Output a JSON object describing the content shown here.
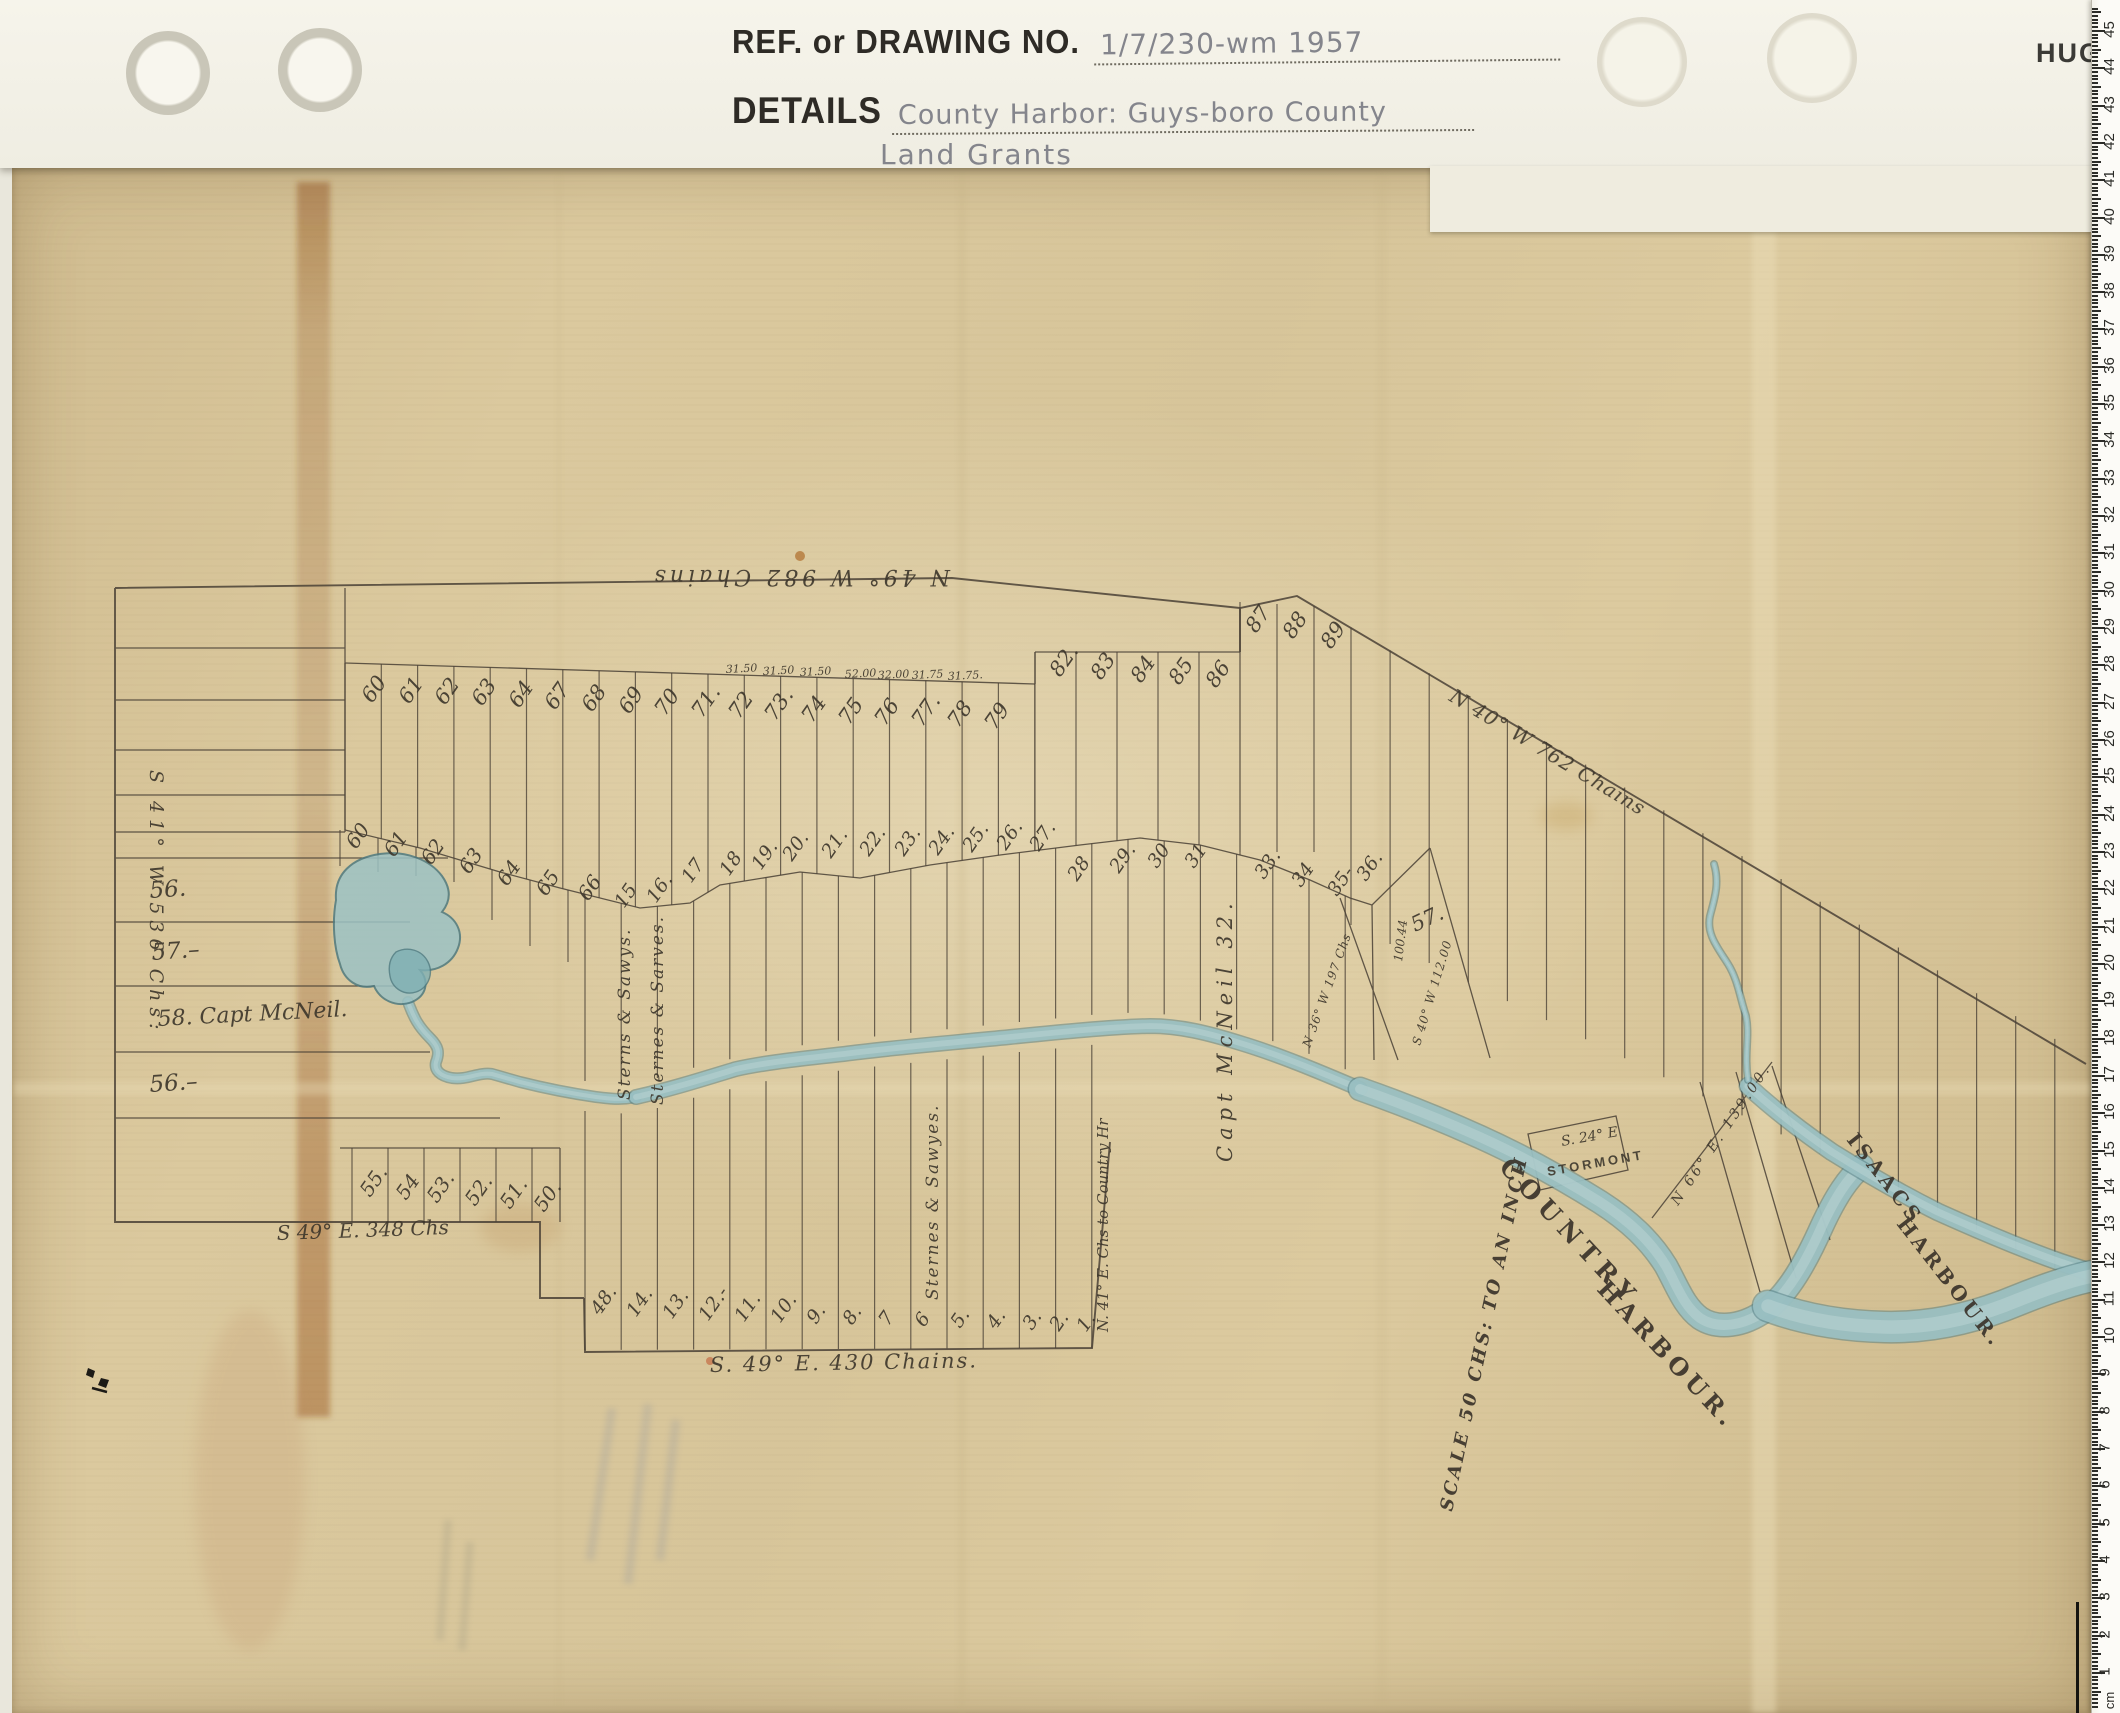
{
  "header": {
    "ref_label": "REF. or DRAWING NO.",
    "ref_value": "1/7/230-wm 1957",
    "details_label": "DETAILS",
    "details_line1": "County Harbor: Guys-boro County",
    "details_line2": "Land Grants",
    "brand_partial": "HUGH"
  },
  "ruler": {
    "unit_label": "cm",
    "min": 1,
    "max": 45
  },
  "colors": {
    "paper": "#d8c69b",
    "ink": "#4a4136",
    "water_light": "#9cc2c4",
    "water_dark": "#4e7a80",
    "stain_brown": "#92541f",
    "pencil": "#84858c"
  },
  "map": {
    "labels": [
      {
        "t": "N 49° W 982 Chains",
        "x": 950,
        "y": 570,
        "r": 180,
        "s": 22,
        "ls": 4,
        "c": "scr"
      },
      {
        "t": "S 41° W 536 Chs:",
        "x": 150,
        "y": 770,
        "r": 90,
        "s": 19,
        "ls": 6,
        "c": "scr"
      },
      {
        "t": "56.",
        "x": 150,
        "y": 898,
        "r": -4,
        "s": 23,
        "c": "scr"
      },
      {
        "t": "57.–",
        "x": 152,
        "y": 960,
        "r": -4,
        "s": 23,
        "c": "scr"
      },
      {
        "t": "58. Capt McNeil.",
        "x": 158,
        "y": 1026,
        "r": -3,
        "s": 22,
        "c": "scr"
      },
      {
        "t": "56.–",
        "x": 150,
        "y": 1092,
        "r": -4,
        "s": 23,
        "c": "scr"
      },
      {
        "t": "S 49° E. 348 Chs",
        "x": 277,
        "y": 1240,
        "r": -2,
        "s": 20,
        "c": "scr"
      },
      {
        "t": "S. 49° E.  430 Chains.",
        "x": 710,
        "y": 1372,
        "r": -1,
        "s": 21,
        "ls": 2,
        "c": "scr"
      },
      {
        "t": "N 40° W 762 Chains",
        "x": 1448,
        "y": 700,
        "r": 31,
        "s": 20,
        "ls": 1,
        "c": "scr"
      },
      {
        "t": "Capt McNeil 32.",
        "x": 1232,
        "y": 1162,
        "r": -90,
        "s": 21,
        "ls": 6,
        "c": "scr"
      },
      {
        "t": "Sterns & Sawys.",
        "x": 630,
        "y": 1100,
        "r": -90,
        "s": 17,
        "ls": 2,
        "c": "scr"
      },
      {
        "t": "Sternes & Sarves.",
        "x": 663,
        "y": 1105,
        "r": -90,
        "s": 17,
        "ls": 2,
        "c": "scr"
      },
      {
        "t": "Sternes & Sawyes.",
        "x": 938,
        "y": 1300,
        "r": -90,
        "s": 17,
        "ls": 2,
        "c": "scr"
      },
      {
        "t": "N. 41° E. Chs to Country Hr",
        "x": 1108,
        "y": 1332,
        "r": -90,
        "s": 15,
        "c": "scr"
      },
      {
        "t": "100.44",
        "x": 1402,
        "y": 962,
        "r": -83,
        "s": 12,
        "c": "scr"
      },
      {
        "t": "57.",
        "x": 1415,
        "y": 932,
        "r": -25,
        "s": 21,
        "c": "scr"
      },
      {
        "t": "S 40° W 112.00",
        "x": 1420,
        "y": 1046,
        "r": -73,
        "s": 12,
        "ls": 1,
        "c": "scr"
      },
      {
        "t": "N 36° W 197 Chs",
        "x": 1310,
        "y": 1048,
        "r": -70,
        "s": 12,
        "ls": 1,
        "c": "scr"
      },
      {
        "t": "S. 24° E",
        "x": 1562,
        "y": 1146,
        "r": -10,
        "s": 14,
        "c": "scr"
      },
      {
        "t": "STORMONT",
        "x": 1548,
        "y": 1176,
        "r": -10,
        "s": 13,
        "ls": 3,
        "c": "prt"
      },
      {
        "t": "N 66° E. 139.00.",
        "x": 1678,
        "y": 1206,
        "r": -56,
        "s": 14,
        "ls": 3,
        "c": "scr"
      },
      {
        "t": "COUNTRY",
        "x": 1498,
        "y": 1168,
        "r": 47,
        "s": 25,
        "ls": 7,
        "c": "prt2"
      },
      {
        "t": "HARBOUR.",
        "x": 1596,
        "y": 1290,
        "r": 47,
        "s": 24,
        "ls": 5,
        "c": "prt2"
      },
      {
        "t": "ISAACS",
        "x": 1846,
        "y": 1140,
        "r": 52,
        "s": 20,
        "ls": 4,
        "c": "prt2"
      },
      {
        "t": "HARBOUR.",
        "x": 1896,
        "y": 1224,
        "r": 52,
        "s": 20,
        "ls": 4,
        "c": "prt2"
      },
      {
        "t": "SCALE 50 CHS: TO AN INCH",
        "x": 1452,
        "y": 1512,
        "r": -78,
        "s": 18,
        "ls": 3,
        "c": "scr2"
      },
      {
        "t": "60",
        "x": 372,
        "y": 704,
        "r": -55,
        "s": 21,
        "c": "scr"
      },
      {
        "t": "61",
        "x": 409,
        "y": 705,
        "r": -55,
        "s": 21,
        "c": "scr"
      },
      {
        "t": "62",
        "x": 445,
        "y": 706,
        "r": -55,
        "s": 21,
        "c": "scr"
      },
      {
        "t": "63",
        "x": 482,
        "y": 707,
        "r": -55,
        "s": 21,
        "c": "scr"
      },
      {
        "t": "64",
        "x": 519,
        "y": 709,
        "r": -55,
        "s": 21,
        "c": "scr"
      },
      {
        "t": "67",
        "x": 555,
        "y": 711,
        "r": -55,
        "s": 21,
        "c": "scr"
      },
      {
        "t": "68",
        "x": 592,
        "y": 713,
        "r": -55,
        "s": 21,
        "c": "scr"
      },
      {
        "t": "69",
        "x": 629,
        "y": 715,
        "r": -55,
        "s": 21,
        "c": "scr"
      },
      {
        "t": "70",
        "x": 665,
        "y": 717,
        "r": -55,
        "s": 21,
        "c": "scr"
      },
      {
        "t": "71.",
        "x": 702,
        "y": 719,
        "r": -55,
        "s": 21,
        "c": "scr"
      },
      {
        "t": "72",
        "x": 739,
        "y": 720,
        "r": -55,
        "s": 21,
        "c": "scr"
      },
      {
        "t": "73.",
        "x": 775,
        "y": 722,
        "r": -55,
        "s": 21,
        "c": "scr"
      },
      {
        "t": "74",
        "x": 812,
        "y": 724,
        "r": -55,
        "s": 21,
        "c": "scr"
      },
      {
        "t": "75",
        "x": 849,
        "y": 726,
        "r": -55,
        "s": 21,
        "c": "scr"
      },
      {
        "t": "76",
        "x": 885,
        "y": 727,
        "r": -55,
        "s": 21,
        "c": "scr"
      },
      {
        "t": "77.",
        "x": 922,
        "y": 728,
        "r": -55,
        "s": 21,
        "c": "scr"
      },
      {
        "t": "78",
        "x": 958,
        "y": 729,
        "r": -55,
        "s": 21,
        "c": "scr"
      },
      {
        "t": "79",
        "x": 995,
        "y": 731,
        "r": -55,
        "s": 21,
        "c": "scr"
      },
      {
        "t": "31.50",
        "x": 726,
        "y": 673,
        "r": -3,
        "s": 11,
        "c": "scr"
      },
      {
        "t": "31.50",
        "x": 763,
        "y": 675,
        "r": -3,
        "s": 11,
        "c": "scr"
      },
      {
        "t": "31.50",
        "x": 800,
        "y": 676,
        "r": -3,
        "s": 11,
        "c": "scr"
      },
      {
        "t": "52.00",
        "x": 845,
        "y": 678,
        "r": -3,
        "s": 11,
        "c": "scr"
      },
      {
        "t": "32.00",
        "x": 878,
        "y": 679,
        "r": -3,
        "s": 11,
        "c": "scr"
      },
      {
        "t": "31.75",
        "x": 912,
        "y": 679,
        "r": -3,
        "s": 11,
        "c": "scr"
      },
      {
        "t": "31.75.",
        "x": 948,
        "y": 680,
        "r": -3,
        "s": 11,
        "c": "scr"
      },
      {
        "t": "82.",
        "x": 1060,
        "y": 678,
        "r": -55,
        "s": 21,
        "c": "scr"
      },
      {
        "t": "83",
        "x": 1101,
        "y": 681,
        "r": -55,
        "s": 21,
        "c": "scr"
      },
      {
        "t": "84",
        "x": 1141,
        "y": 684,
        "r": -55,
        "s": 21,
        "c": "scr"
      },
      {
        "t": "85",
        "x": 1179,
        "y": 686,
        "r": -55,
        "s": 21,
        "c": "scr"
      },
      {
        "t": "86",
        "x": 1216,
        "y": 689,
        "r": -55,
        "s": 21,
        "c": "scr"
      },
      {
        "t": "87",
        "x": 1256,
        "y": 634,
        "r": -55,
        "s": 21,
        "c": "scr"
      },
      {
        "t": "88",
        "x": 1293,
        "y": 640,
        "r": -55,
        "s": 21,
        "c": "scr"
      },
      {
        "t": "89",
        "x": 1331,
        "y": 650,
        "r": -55,
        "s": 21,
        "c": "scr"
      },
      {
        "t": "60",
        "x": 356,
        "y": 850,
        "r": -55,
        "s": 20,
        "c": "scr"
      },
      {
        "t": "61",
        "x": 394,
        "y": 858,
        "r": -55,
        "s": 20,
        "c": "scr"
      },
      {
        "t": "62",
        "x": 431,
        "y": 866,
        "r": -55,
        "s": 20,
        "c": "scr"
      },
      {
        "t": "63",
        "x": 469,
        "y": 875,
        "r": -55,
        "s": 20,
        "c": "scr"
      },
      {
        "t": "64",
        "x": 507,
        "y": 887,
        "r": -55,
        "s": 20,
        "c": "scr"
      },
      {
        "t": "65",
        "x": 546,
        "y": 897,
        "r": -55,
        "s": 20,
        "c": "scr"
      },
      {
        "t": "66",
        "x": 588,
        "y": 902,
        "r": -55,
        "s": 20,
        "c": "scr"
      },
      {
        "t": "15",
        "x": 624,
        "y": 909,
        "r": -55,
        "s": 19,
        "c": "scr"
      },
      {
        "t": "16.",
        "x": 656,
        "y": 904,
        "r": -55,
        "s": 19,
        "c": "scr"
      },
      {
        "t": "17",
        "x": 691,
        "y": 884,
        "r": -55,
        "s": 19,
        "c": "scr"
      },
      {
        "t": "18",
        "x": 729,
        "y": 877,
        "r": -55,
        "s": 19,
        "c": "scr"
      },
      {
        "t": "19.",
        "x": 761,
        "y": 871,
        "r": -55,
        "s": 19,
        "c": "scr"
      },
      {
        "t": "20.",
        "x": 792,
        "y": 862,
        "r": -55,
        "s": 19,
        "c": "scr"
      },
      {
        "t": "21.",
        "x": 831,
        "y": 859,
        "r": -55,
        "s": 19,
        "c": "scr"
      },
      {
        "t": "22.",
        "x": 869,
        "y": 857,
        "r": -55,
        "s": 19,
        "c": "scr"
      },
      {
        "t": "23.",
        "x": 904,
        "y": 857,
        "r": -55,
        "s": 19,
        "c": "scr"
      },
      {
        "t": "24.",
        "x": 938,
        "y": 856,
        "r": -55,
        "s": 19,
        "c": "scr"
      },
      {
        "t": "25.",
        "x": 972,
        "y": 853,
        "r": -55,
        "s": 19,
        "c": "scr"
      },
      {
        "t": "26.",
        "x": 1006,
        "y": 851,
        "r": -55,
        "s": 19,
        "c": "scr"
      },
      {
        "t": "27.",
        "x": 1039,
        "y": 852,
        "r": -55,
        "s": 19,
        "c": "scr"
      },
      {
        "t": "28",
        "x": 1077,
        "y": 882,
        "r": -55,
        "s": 19,
        "c": "scr"
      },
      {
        "t": "29.",
        "x": 1119,
        "y": 874,
        "r": -55,
        "s": 19,
        "c": "scr"
      },
      {
        "t": "30",
        "x": 1157,
        "y": 869,
        "r": -55,
        "s": 19,
        "c": "scr"
      },
      {
        "t": "31",
        "x": 1194,
        "y": 869,
        "r": -55,
        "s": 19,
        "c": "scr"
      },
      {
        "t": "33.",
        "x": 1264,
        "y": 880,
        "r": -55,
        "s": 19,
        "c": "scr"
      },
      {
        "t": "34",
        "x": 1301,
        "y": 888,
        "r": -55,
        "s": 19,
        "c": "scr"
      },
      {
        "t": "35-",
        "x": 1337,
        "y": 897,
        "r": -55,
        "s": 19,
        "c": "scr"
      },
      {
        "t": "36.",
        "x": 1366,
        "y": 882,
        "r": -55,
        "s": 19,
        "c": "scr"
      },
      {
        "t": "55.",
        "x": 370,
        "y": 1198,
        "r": -55,
        "s": 20,
        "c": "scr"
      },
      {
        "t": "54",
        "x": 406,
        "y": 1201,
        "r": -55,
        "s": 20,
        "c": "scr"
      },
      {
        "t": "53.",
        "x": 437,
        "y": 1204,
        "r": -55,
        "s": 20,
        "c": "scr"
      },
      {
        "t": "52.",
        "x": 475,
        "y": 1207,
        "r": -55,
        "s": 20,
        "c": "scr"
      },
      {
        "t": "51.",
        "x": 510,
        "y": 1210,
        "r": -55,
        "s": 20,
        "c": "scr"
      },
      {
        "t": "50.",
        "x": 544,
        "y": 1213,
        "r": -55,
        "s": 20,
        "c": "scr"
      },
      {
        "t": "48.",
        "x": 600,
        "y": 1316,
        "r": -55,
        "s": 19,
        "c": "scr"
      },
      {
        "t": "14.",
        "x": 636,
        "y": 1318,
        "r": -55,
        "s": 19,
        "c": "scr"
      },
      {
        "t": "13.",
        "x": 672,
        "y": 1320,
        "r": -55,
        "s": 19,
        "c": "scr"
      },
      {
        "t": "12.-",
        "x": 708,
        "y": 1322,
        "r": -55,
        "s": 19,
        "c": "scr"
      },
      {
        "t": "11.",
        "x": 744,
        "y": 1323,
        "r": -55,
        "s": 19,
        "c": "scr"
      },
      {
        "t": "10.",
        "x": 780,
        "y": 1324,
        "r": -55,
        "s": 19,
        "c": "scr"
      },
      {
        "t": "9.",
        "x": 816,
        "y": 1325,
        "r": -55,
        "s": 19,
        "c": "scr"
      },
      {
        "t": "8.",
        "x": 852,
        "y": 1326,
        "r": -55,
        "s": 19,
        "c": "scr"
      },
      {
        "t": "7",
        "x": 888,
        "y": 1327,
        "r": -55,
        "s": 19,
        "c": "scr"
      },
      {
        "t": "6",
        "x": 924,
        "y": 1328,
        "r": -55,
        "s": 19,
        "c": "scr"
      },
      {
        "t": "5.",
        "x": 960,
        "y": 1329,
        "r": -55,
        "s": 19,
        "c": "scr"
      },
      {
        "t": "4.",
        "x": 996,
        "y": 1330,
        "r": -55,
        "s": 19,
        "c": "scr"
      },
      {
        "t": "3.",
        "x": 1032,
        "y": 1331,
        "r": -55,
        "s": 19,
        "c": "scr"
      },
      {
        "t": "2.",
        "x": 1059,
        "y": 1332,
        "r": -55,
        "s": 19,
        "c": "scr"
      },
      {
        "t": "1.",
        "x": 1086,
        "y": 1333,
        "r": -55,
        "s": 19,
        "c": "scr"
      }
    ]
  }
}
